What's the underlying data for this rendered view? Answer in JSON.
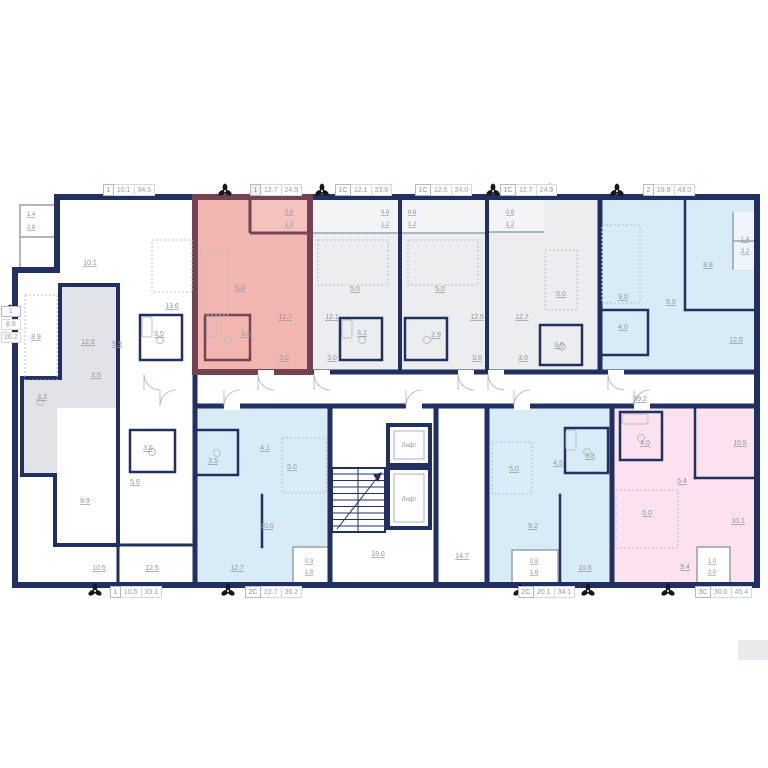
{
  "plan": {
    "colors": {
      "wall": "#223061",
      "wall_highlight": "#744251",
      "fill_highlight": "#f2b6b1",
      "fill_highlight_balcony": "#f5c3be",
      "fill_blue": "#d8ecf8",
      "fill_pink": "#fbe2ee",
      "fill_gray": "#e2e3e6",
      "fill_light": "#ecedef",
      "label_text": "#8d94a1",
      "fixture": "#b8bfcc",
      "thin_wall": "#95a0b4"
    },
    "unit_tags_top": [
      {
        "type": "1",
        "room": "10.1",
        "total": "34.5",
        "x": 103
      },
      {
        "type": "1",
        "room": "12.7",
        "total": "24.9",
        "x": 250,
        "highlighted": true
      },
      {
        "type": "1С",
        "room": "12.1",
        "total": "23.8",
        "x": 335
      },
      {
        "type": "1С",
        "room": "12.5",
        "total": "24.0",
        "x": 415
      },
      {
        "type": "1С",
        "room": "12.7",
        "total": "24.9",
        "x": 500
      },
      {
        "type": "2",
        "room": "19.8",
        "total": "43.0",
        "x": 643
      }
    ],
    "unit_tags_bottom": [
      {
        "type": "1",
        "room": "10.5",
        "total": "33.1",
        "x": 110
      },
      {
        "type": "2С",
        "room": "22.7",
        "total": "36.2",
        "x": 245
      },
      {
        "type": "2С",
        "room": "20.1",
        "total": "34.1",
        "x": 518
      },
      {
        "type": "3С",
        "room": "30.0",
        "total": "45.4",
        "x": 695
      }
    ],
    "unit_tag_left": {
      "type": "1",
      "room": "8.9",
      "total": "26.2"
    },
    "elevators": [
      {
        "label": "Лифт",
        "x": 409,
        "y": 447
      },
      {
        "label": "Лифт",
        "x": 409,
        "y": 501
      }
    ],
    "room_labels": [
      {
        "v": "1.4",
        "x": 31,
        "y": 216,
        "s": 6
      },
      {
        "v": "2.8",
        "x": 31,
        "y": 229,
        "s": 6
      },
      {
        "v": "10.1",
        "x": 90,
        "y": 265
      },
      {
        "v": "13.6",
        "x": 172,
        "y": 308
      },
      {
        "v": "3.5",
        "x": 159,
        "y": 336
      },
      {
        "v": "5.9",
        "x": 117,
        "y": 346
      },
      {
        "v": "8.9",
        "x": 36,
        "y": 339
      },
      {
        "v": "12.5",
        "x": 88,
        "y": 344
      },
      {
        "v": "2.6",
        "x": 96,
        "y": 377
      },
      {
        "v": "3.3",
        "x": 42,
        "y": 399
      },
      {
        "v": "8.9",
        "x": 85,
        "y": 503
      },
      {
        "v": "0.6",
        "x": 289,
        "y": 214,
        "s": 6
      },
      {
        "v": "1.2",
        "x": 289,
        "y": 226,
        "s": 6
      },
      {
        "v": "5.0",
        "x": 240,
        "y": 290
      },
      {
        "v": "12.7",
        "x": 285,
        "y": 319
      },
      {
        "v": "3.6",
        "x": 246,
        "y": 336
      },
      {
        "v": "3.0",
        "x": 284,
        "y": 360
      },
      {
        "v": "0.6",
        "x": 385,
        "y": 214,
        "s": 6
      },
      {
        "v": "1.2",
        "x": 385,
        "y": 226,
        "s": 6
      },
      {
        "v": "5.0",
        "x": 355,
        "y": 291
      },
      {
        "v": "12.1",
        "x": 332,
        "y": 319
      },
      {
        "v": "3.1",
        "x": 362,
        "y": 335
      },
      {
        "v": "3.0",
        "x": 332,
        "y": 360
      },
      {
        "v": "0.6",
        "x": 412,
        "y": 214,
        "s": 6
      },
      {
        "v": "1.2",
        "x": 412,
        "y": 226,
        "s": 6
      },
      {
        "v": "5.0",
        "x": 440,
        "y": 291
      },
      {
        "v": "12.5",
        "x": 477,
        "y": 319
      },
      {
        "v": "2.9",
        "x": 436,
        "y": 337
      },
      {
        "v": "3.0",
        "x": 477,
        "y": 360
      },
      {
        "v": "0.6",
        "x": 510,
        "y": 214,
        "s": 6
      },
      {
        "v": "1.2",
        "x": 510,
        "y": 226,
        "s": 6
      },
      {
        "v": "5.0",
        "x": 561,
        "y": 296
      },
      {
        "v": "12.7",
        "x": 522,
        "y": 319
      },
      {
        "v": "3.6",
        "x": 559,
        "y": 347
      },
      {
        "v": "3.0",
        "x": 523,
        "y": 360
      },
      {
        "v": "1.4",
        "x": 745,
        "y": 241,
        "s": 6
      },
      {
        "v": "3.2",
        "x": 745,
        "y": 253,
        "s": 6
      },
      {
        "v": "9.0",
        "x": 623,
        "y": 299
      },
      {
        "v": "8.8",
        "x": 708,
        "y": 267
      },
      {
        "v": "5.6",
        "x": 671,
        "y": 304
      },
      {
        "v": "4.0",
        "x": 623,
        "y": 329
      },
      {
        "v": "12.0",
        "x": 736,
        "y": 342
      },
      {
        "v": "39.2",
        "x": 640,
        "y": 401
      },
      {
        "v": "14.7",
        "x": 462,
        "y": 558
      },
      {
        "v": "18.0",
        "x": 378,
        "y": 556
      },
      {
        "v": "3.6",
        "x": 148,
        "y": 450
      },
      {
        "v": "5.6",
        "x": 135,
        "y": 484
      },
      {
        "v": "10.5",
        "x": 99,
        "y": 570
      },
      {
        "v": "12.5",
        "x": 152,
        "y": 570
      },
      {
        "v": "3.5",
        "x": 213,
        "y": 463
      },
      {
        "v": "4.1",
        "x": 265,
        "y": 450
      },
      {
        "v": "5.0",
        "x": 292,
        "y": 469
      },
      {
        "v": "10.0",
        "x": 267,
        "y": 528
      },
      {
        "v": "12.7",
        "x": 237,
        "y": 570
      },
      {
        "v": "0.9",
        "x": 309,
        "y": 563,
        "s": 6
      },
      {
        "v": "1.8",
        "x": 309,
        "y": 574,
        "s": 6
      },
      {
        "v": "5.0",
        "x": 514,
        "y": 471
      },
      {
        "v": "4.5",
        "x": 558,
        "y": 465
      },
      {
        "v": "3.8",
        "x": 590,
        "y": 458
      },
      {
        "v": "9.2",
        "x": 533,
        "y": 528
      },
      {
        "v": "0.8",
        "x": 534,
        "y": 563,
        "s": 6
      },
      {
        "v": "1.6",
        "x": 534,
        "y": 574,
        "s": 6
      },
      {
        "v": "10.8",
        "x": 585,
        "y": 570
      },
      {
        "v": "4.0",
        "x": 645,
        "y": 445
      },
      {
        "v": "5.4",
        "x": 682,
        "y": 483
      },
      {
        "v": "5.0",
        "x": 647,
        "y": 515
      },
      {
        "v": "10.5",
        "x": 740,
        "y": 445
      },
      {
        "v": "10.1",
        "x": 738,
        "y": 523
      },
      {
        "v": "9.4",
        "x": 685,
        "y": 569
      },
      {
        "v": "1.0",
        "x": 712,
        "y": 563,
        "s": 6
      },
      {
        "v": "2.0",
        "x": 712,
        "y": 574,
        "s": 6
      }
    ],
    "fan_icons": {
      "top": [
        [
          225,
          191
        ],
        [
          322,
          191
        ],
        [
          493,
          191
        ],
        [
          550,
          191
        ],
        [
          617,
          191
        ]
      ],
      "bottom": [
        [
          95,
          591
        ],
        [
          228,
          591
        ],
        [
          520,
          591
        ],
        [
          588,
          591
        ],
        [
          668,
          591
        ]
      ],
      "left": [
        [
          10,
          312
        ]
      ]
    }
  }
}
